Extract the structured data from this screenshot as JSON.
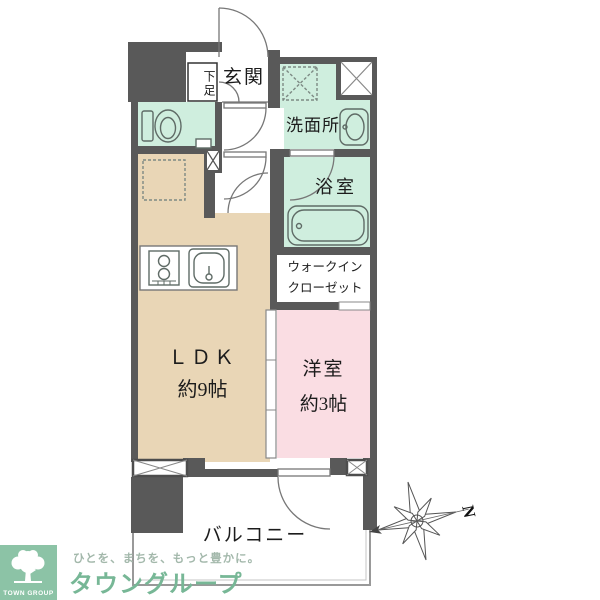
{
  "floorplan": {
    "rooms": {
      "genkan": {
        "label": "玄関"
      },
      "shoe_cabinet": {
        "label": "下足"
      },
      "washroom": {
        "label": "洗面所"
      },
      "bathroom": {
        "label": "浴室"
      },
      "walk_in_closet": {
        "line1": "ウォークイン",
        "line2": "クローゼット"
      },
      "ldk": {
        "line1": "ＬＤＫ",
        "line2": "約9帖"
      },
      "western_room": {
        "line1": "洋室",
        "line2": "約3帖"
      },
      "balcony": {
        "label": "バルコニー"
      }
    },
    "compass": {
      "north_label": "N"
    },
    "colors": {
      "wall": "#595959",
      "wet_area": "#cfeede",
      "ldk_floor": "#e9d6b6",
      "bedroom_floor": "#fadde3",
      "line": "#808080",
      "label_text": "#1c1c1c"
    }
  },
  "branding": {
    "badge_label": "TOWN GROUP",
    "tagline": "ひとを、まちを、もっと豊かに。",
    "company": "タウングループ",
    "colors": {
      "badge_bg": "#8cc3a6",
      "company_text": "#77b796",
      "tagline_text": "#a3b8ab"
    }
  }
}
